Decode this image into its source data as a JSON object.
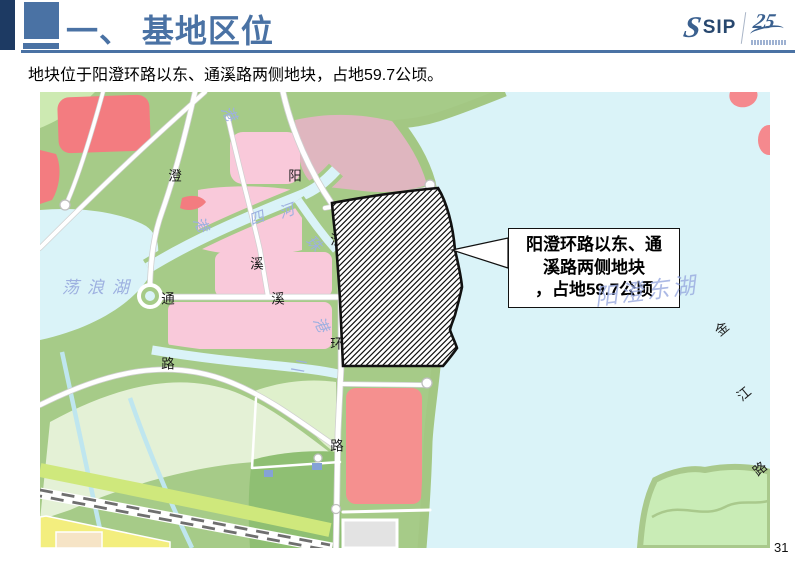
{
  "header": {
    "title": "一、 基地区位"
  },
  "logo": {
    "s_mark": "S",
    "sip": "SIP",
    "anniversary": "25"
  },
  "subtitle": "地块位于阳澄环路以东、通溪路两侧地块，占地59.7公顷。",
  "callout": {
    "lines": [
      "阳澄环路以东、通",
      "溪路两侧地块",
      "，占地59.7公顷"
    ]
  },
  "map": {
    "lake_label": "阳澄东湖",
    "road_labels": [
      "澄",
      "阳",
      "溪",
      "通",
      "溪",
      "澄",
      "环",
      "路",
      "路",
      "金",
      "江",
      "路"
    ],
    "water_labels": [
      "港",
      "港",
      "四",
      "河",
      "珠",
      "港",
      "二",
      "荡浪湖"
    ]
  },
  "page_number": "31",
  "colors": {
    "accent": "#4a72a4",
    "dark_accent": "#1d3a63",
    "water": "#daf3f8",
    "park_green": "#a6cb88",
    "field_green": "#e4f1d6",
    "pink_block": "#f9c9da",
    "red_block": "#f37c80",
    "rose_block": "#dfb6bf",
    "hatch": "#111111"
  }
}
